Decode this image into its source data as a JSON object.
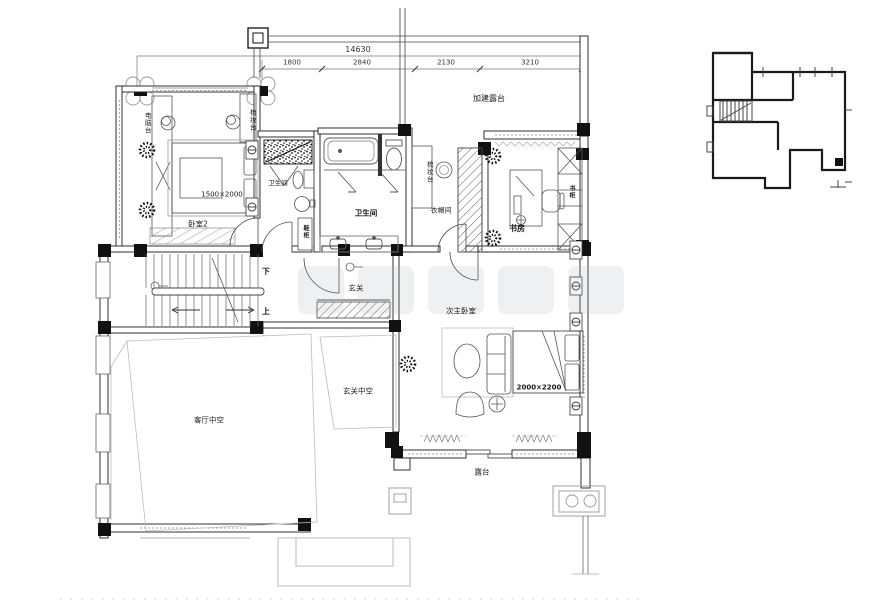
{
  "drawing": {
    "dimensions": {
      "total": "14630",
      "seg1": "1800",
      "seg2": "2840",
      "seg3": "2130",
      "seg4": "3210"
    },
    "labels": {
      "added_terrace": "加建露台",
      "bedroom2": "卧室2",
      "bedroom2_bed": "1500×2000",
      "computer_desk": "电脑台",
      "dresser_bedroom": "梳妆台",
      "bath_small": "卫生间",
      "bath_main": "卫生间",
      "dresser_closet": "梳妆台",
      "cloakroom": "衣帽间",
      "study": "书房",
      "bookcase": "书柜",
      "shoe_cabinet": "鞋柜",
      "foyer": "玄关",
      "stairs_down": "下",
      "stairs_up": "上",
      "second_master": "次主卧室",
      "second_master_bed": "2000×2200",
      "foyer_void": "玄关中空",
      "living_void": "客厅中空",
      "terrace": "露台"
    }
  }
}
